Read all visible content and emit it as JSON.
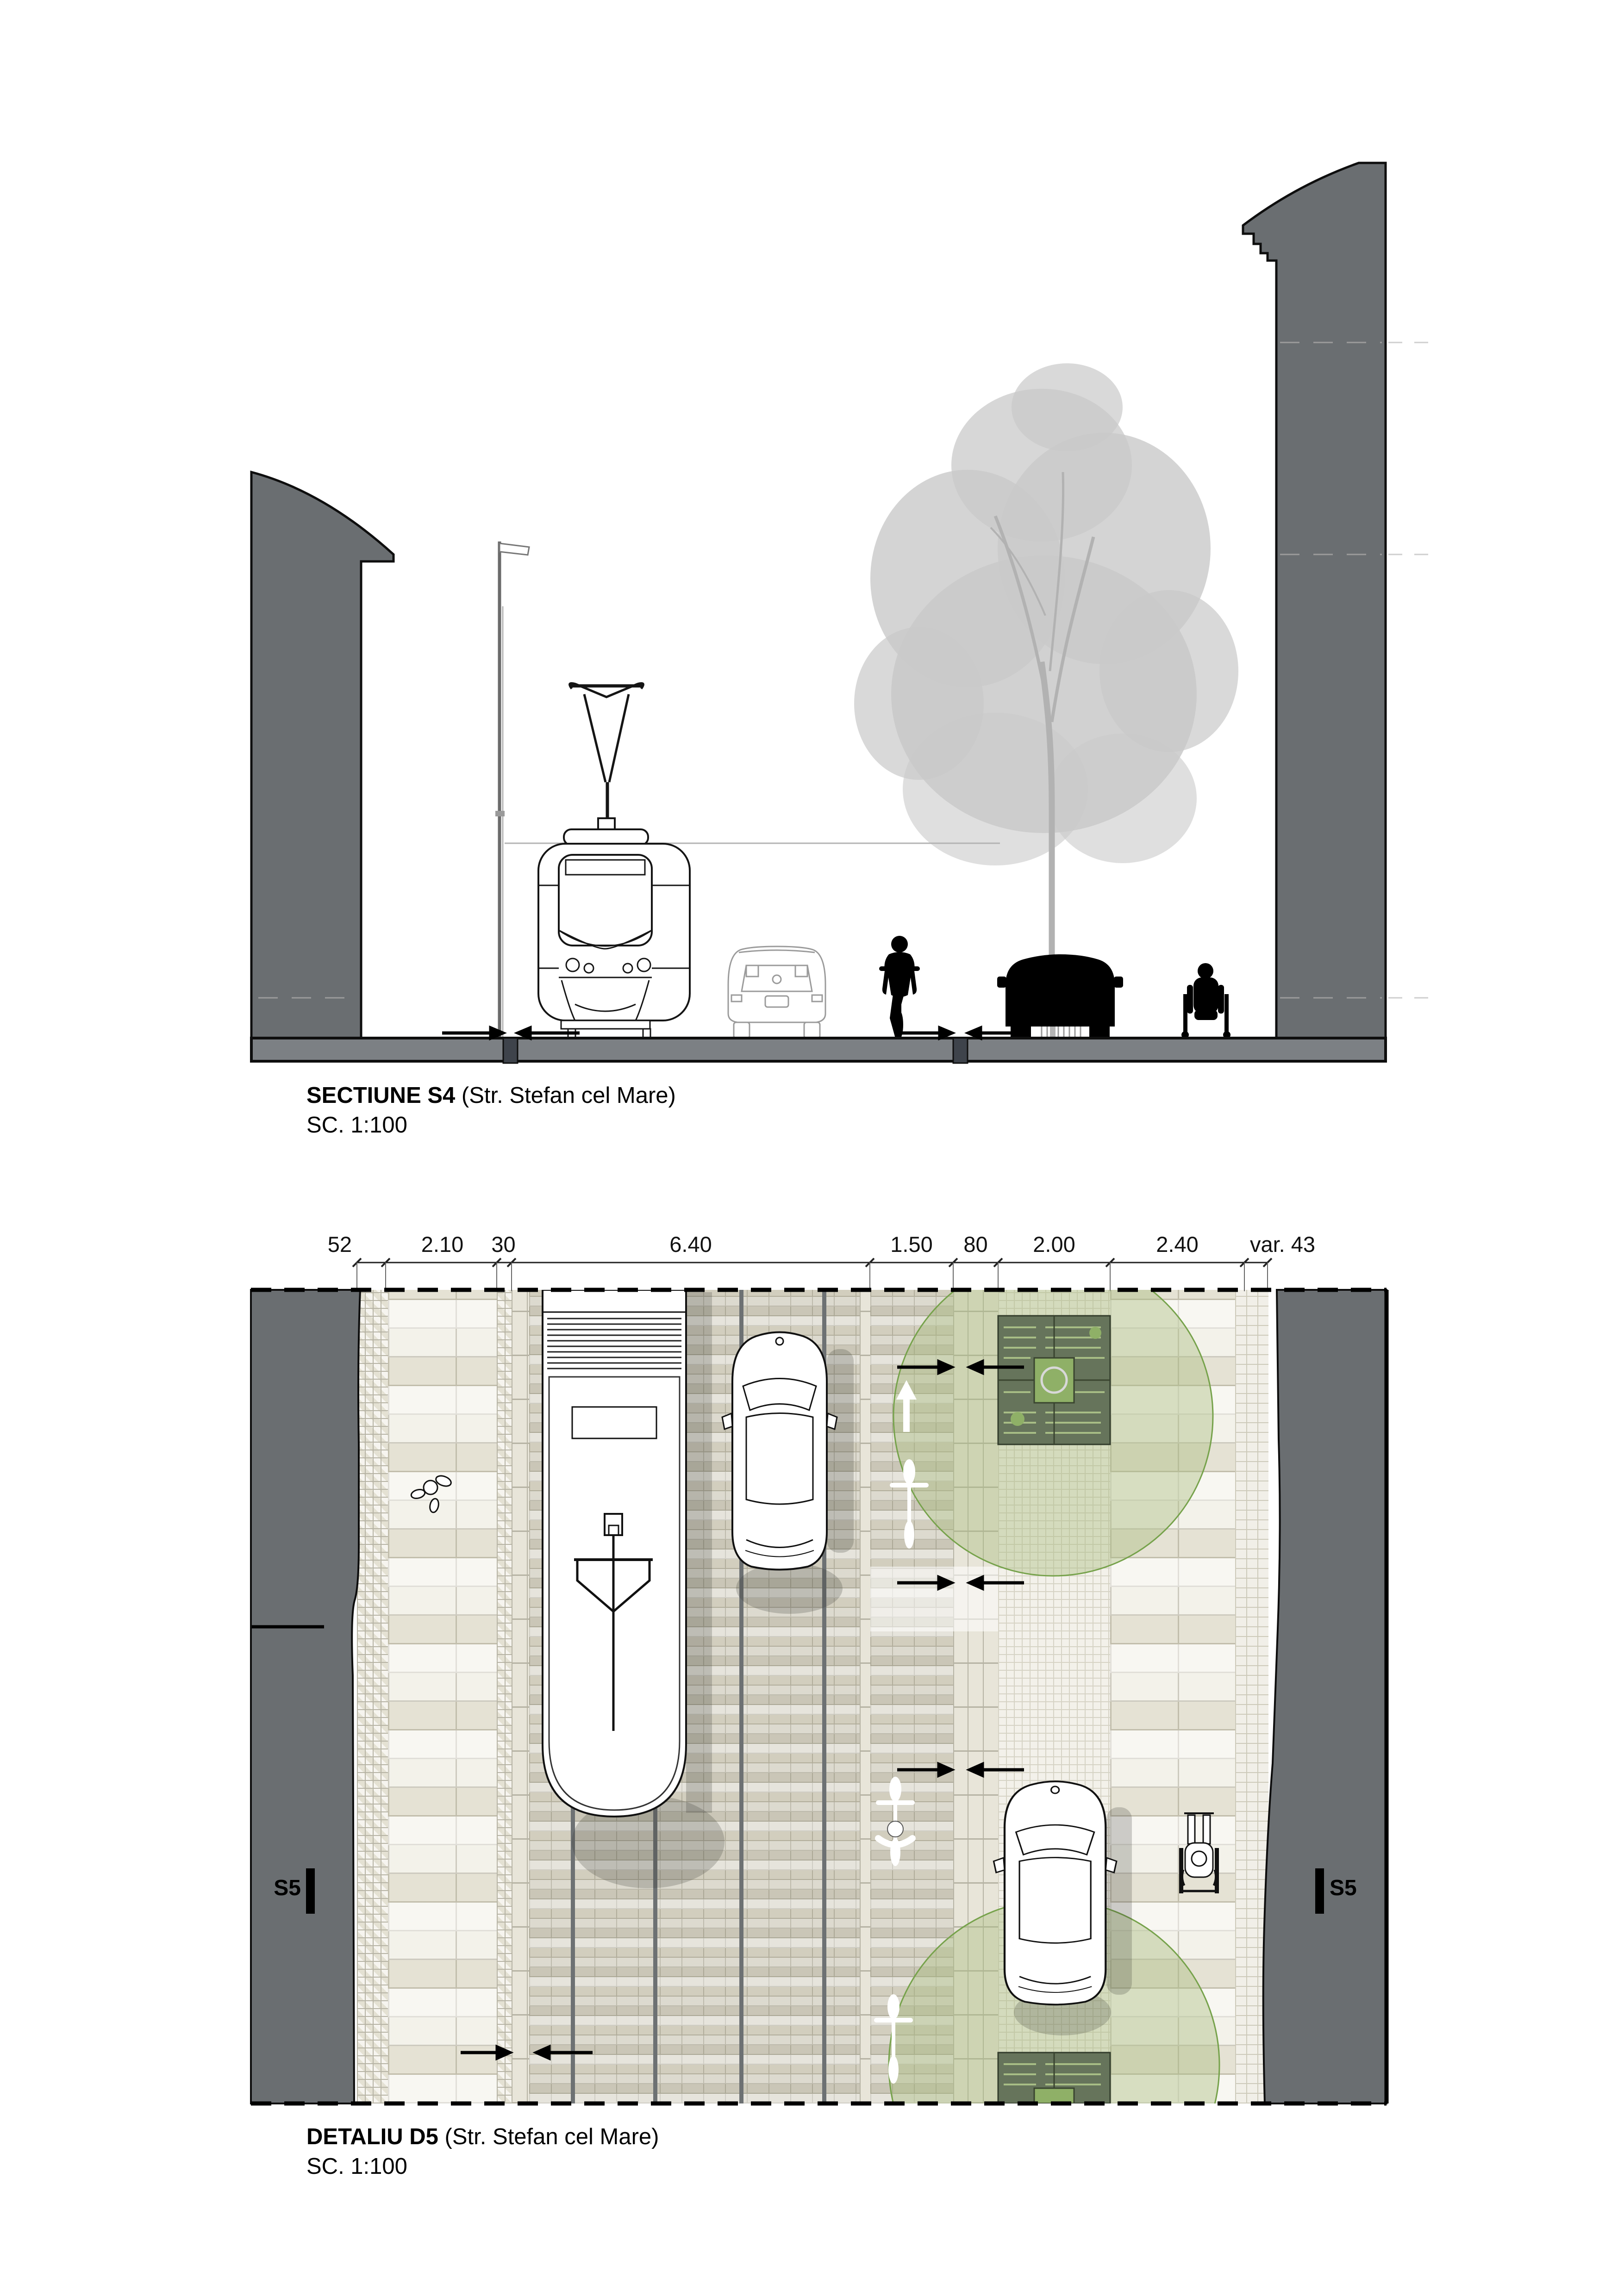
{
  "titles": {
    "section_bold": "SECTIUNE S4",
    "section_rest": " (Str. Stefan cel Mare)",
    "section_scale": "SC. 1:100",
    "detail_bold": "DETALIU D5",
    "detail_rest": " (Str. Stefan cel Mare)",
    "detail_scale": "SC. 1:100"
  },
  "markers": {
    "left": "S5",
    "right": "S5"
  },
  "dimensions": {
    "items": [
      {
        "label": "52"
      },
      {
        "label": "2.10"
      },
      {
        "label": "30"
      },
      {
        "label": "6.40"
      },
      {
        "label": "1.50"
      },
      {
        "label": "80"
      },
      {
        "label": "2.00"
      },
      {
        "label": "2.40"
      },
      {
        "label": "var. 43"
      }
    ]
  },
  "icons": [
    "tram-icon",
    "car-icon",
    "suv-icon",
    "bicycle-icon",
    "cyclist-icon",
    "pedestrian-icon",
    "wheelchair-icon",
    "tree-icon",
    "street-lamp-icon",
    "arrow-slope-icon",
    "tree-grate-icon"
  ],
  "colors": {
    "building_gray": "#6a6e71",
    "ground_gray": "#7c8084",
    "rail_gray": "#6d7173",
    "canopy_green_fill": "#a9bd7e",
    "canopy_green_stroke": "#76a24b",
    "tree_pit_green": "#66745b",
    "tree_pit_center": "#8fb067",
    "paving_beige": "#d7d4c7",
    "slab_light": "#efede3",
    "shadow": "rgba(50,50,45,0.22)"
  }
}
